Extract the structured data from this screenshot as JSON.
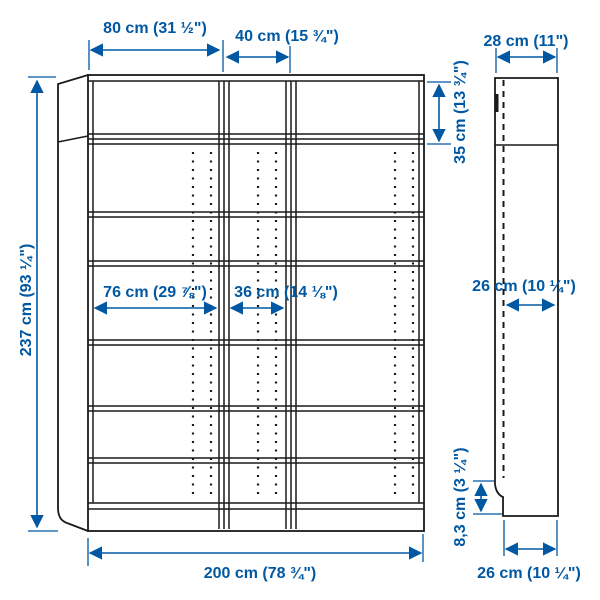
{
  "diagram": {
    "kind": "bookcase-dimension-drawing",
    "views": {
      "front": {
        "width_left_unit": "80 cm (31 ½\")",
        "width_middle_unit": "40 cm (15 ¾\")",
        "height_total": "237 cm (93 ¼\")",
        "extension_height": "35 cm (13 ¾\")",
        "inner_width_left_unit": "76 cm (29 ⅞\")",
        "inner_width_middle_unit": "36 cm (14 ⅛\")",
        "width_total": "200 cm (78 ¾\")"
      },
      "side": {
        "depth_top": "28 cm (11\")",
        "depth_inner": "26 cm (10 ¼\")",
        "plinth_height": "8,3 cm (3 ¼\")",
        "depth_bottom": "26 cm (10 ¼\")"
      }
    },
    "colors": {
      "dimension_blue": "#0058a3",
      "drawing_line": "#1a1a1a",
      "background": "#ffffff"
    }
  }
}
